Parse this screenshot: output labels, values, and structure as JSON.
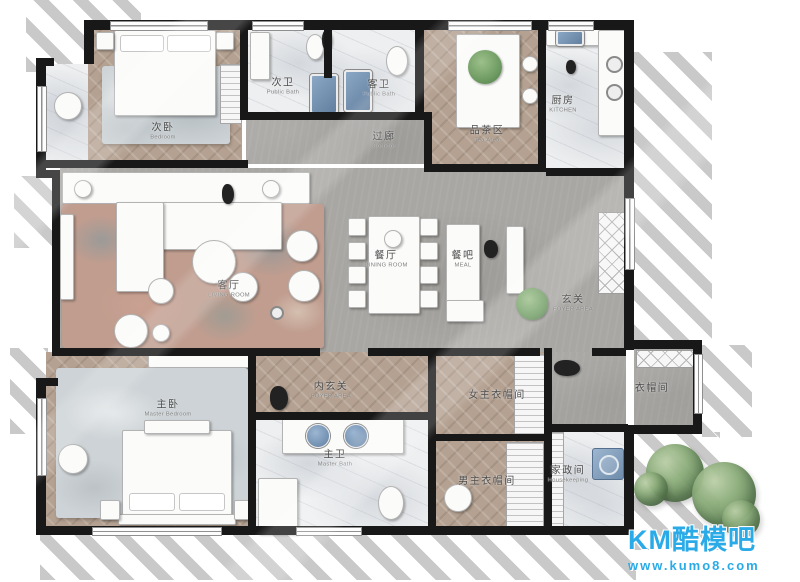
{
  "watermark": {
    "brand": "KM酷模吧",
    "url": "www.kumo8.com"
  },
  "rooms": [
    {
      "cn": "次卧",
      "en": "Bedroom"
    },
    {
      "cn": "次卫",
      "en": "Public Bath"
    },
    {
      "cn": "客卫",
      "en": "Public Bath"
    },
    {
      "cn": "过廊",
      "en": "Corridor"
    },
    {
      "cn": "品茶区",
      "en": "Tea Area"
    },
    {
      "cn": "厨房",
      "en": "KITCHEN"
    },
    {
      "cn": "客厅",
      "en": "LIVING ROOM"
    },
    {
      "cn": "餐厅",
      "en": "DINING ROOM"
    },
    {
      "cn": "餐吧",
      "en": "MEAL"
    },
    {
      "cn": "玄关",
      "en": "FOYER AREA"
    },
    {
      "cn": "内玄关",
      "en": "FOYER AREA"
    },
    {
      "cn": "主卧",
      "en": "Master Bedroom"
    },
    {
      "cn": "主卫",
      "en": "Master Bath"
    },
    {
      "cn": "女主衣帽间",
      "en": ""
    },
    {
      "cn": "男主衣帽间",
      "en": ""
    },
    {
      "cn": "家政间",
      "en": "Housekeeping"
    },
    {
      "cn": "衣帽间",
      "en": ""
    }
  ],
  "colors": {
    "wall": "#181818",
    "wood": "#b4a191",
    "marble": "#edeff0",
    "concrete": "#a9a7a3",
    "rug_living": "#c09d8f",
    "rug_master": "#cdd3d6",
    "fixture_blue": "#7095b8",
    "plant_green": "#6f9c63",
    "tree_green": "#6d9160",
    "shadow_gray": "#8c8c8c",
    "watermark_blue": "#2aabe8",
    "label_text": "#4c4c4c"
  }
}
